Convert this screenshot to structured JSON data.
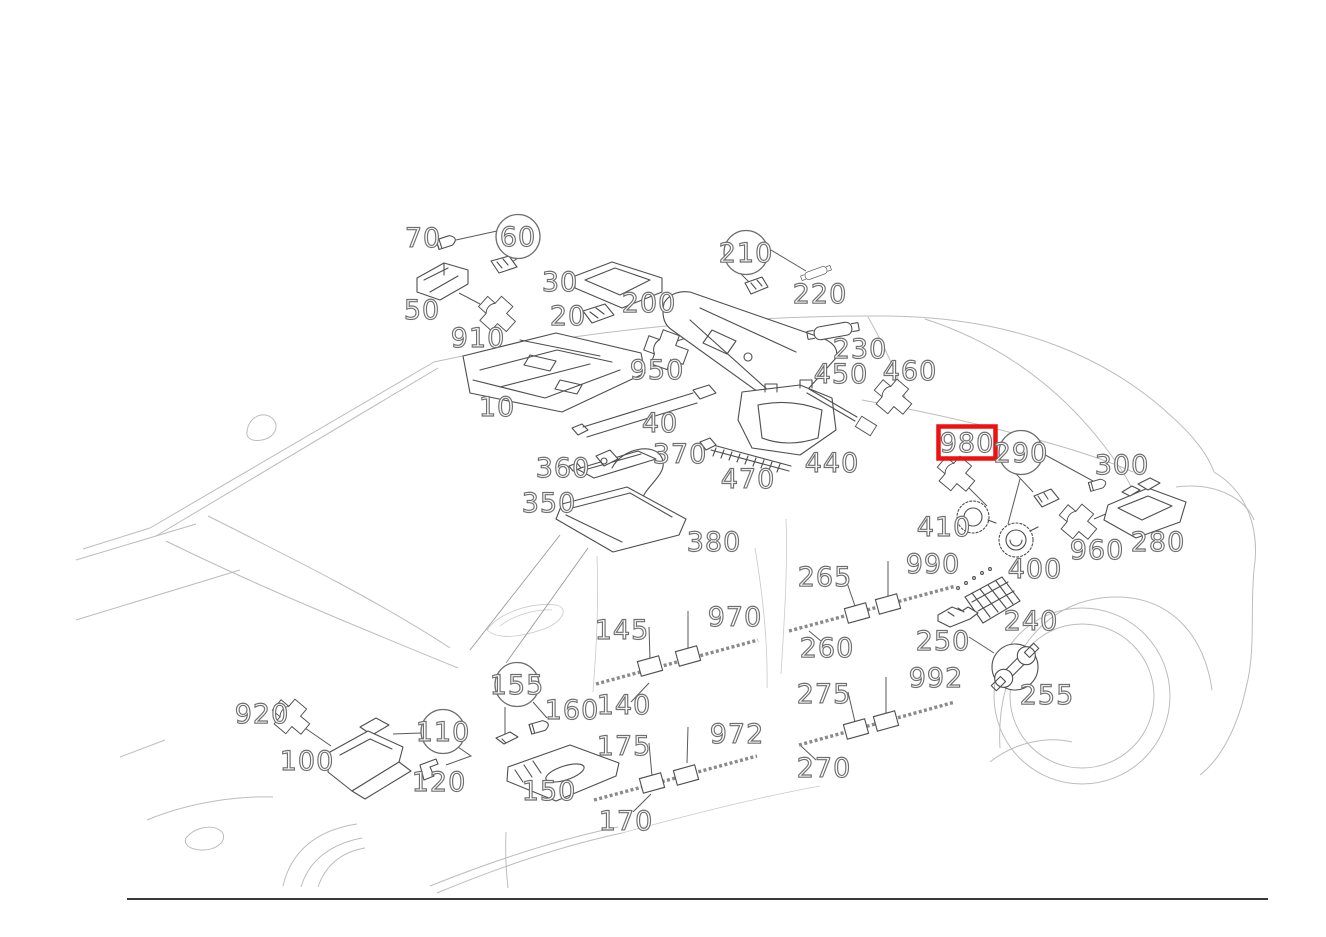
{
  "diagram": {
    "type": "exploded-parts-diagram",
    "background": "#ffffff",
    "car_outline_color": "#bcbcbc",
    "sketch_color": "#4e4e4e",
    "label_style": {
      "fill": "#ffffff",
      "outline": "#6f6f6f",
      "font_size": 27
    },
    "highlight": {
      "part": "980",
      "color": "#ee1111"
    },
    "footer_rule": {
      "y": 899,
      "x1": 127,
      "x2": 1268
    },
    "tool_icon": {
      "name": "wrench",
      "cx": 1015,
      "cy": 667,
      "r": 23,
      "for_part": "255"
    },
    "callouts": [
      {
        "label": "70",
        "x": 423,
        "y": 247,
        "kind": "plain"
      },
      {
        "label": "60",
        "x": 518,
        "y": 246,
        "kind": "circled"
      },
      {
        "label": "50",
        "x": 422,
        "y": 319,
        "kind": "plain"
      },
      {
        "label": "910",
        "x": 478,
        "y": 347,
        "kind": "plain"
      },
      {
        "label": "30",
        "x": 560,
        "y": 291,
        "kind": "plain"
      },
      {
        "label": "20",
        "x": 568,
        "y": 325,
        "kind": "plain"
      },
      {
        "label": "200",
        "x": 649,
        "y": 312,
        "kind": "plain"
      },
      {
        "label": "950",
        "x": 657,
        "y": 379,
        "kind": "plain"
      },
      {
        "label": "210",
        "x": 746,
        "y": 262,
        "kind": "circled"
      },
      {
        "label": "220",
        "x": 820,
        "y": 303,
        "kind": "plain"
      },
      {
        "label": "230",
        "x": 860,
        "y": 358,
        "kind": "plain"
      },
      {
        "label": "450",
        "x": 841,
        "y": 383,
        "kind": "plain"
      },
      {
        "label": "460",
        "x": 910,
        "y": 380,
        "kind": "plain"
      },
      {
        "label": "980",
        "x": 967,
        "y": 452,
        "kind": "highlighted"
      },
      {
        "label": "290",
        "x": 1021,
        "y": 462,
        "kind": "circled"
      },
      {
        "label": "300",
        "x": 1122,
        "y": 474,
        "kind": "plain"
      },
      {
        "label": "10",
        "x": 497,
        "y": 416,
        "kind": "plain"
      },
      {
        "label": "40",
        "x": 660,
        "y": 432,
        "kind": "plain"
      },
      {
        "label": "360",
        "x": 563,
        "y": 477,
        "kind": "plain"
      },
      {
        "label": "370",
        "x": 680,
        "y": 463,
        "kind": "plain"
      },
      {
        "label": "470",
        "x": 748,
        "y": 488,
        "kind": "plain"
      },
      {
        "label": "440",
        "x": 832,
        "y": 472,
        "kind": "plain"
      },
      {
        "label": "350",
        "x": 549,
        "y": 512,
        "kind": "plain"
      },
      {
        "label": "380",
        "x": 714,
        "y": 551,
        "kind": "plain"
      },
      {
        "label": "410",
        "x": 944,
        "y": 536,
        "kind": "plain"
      },
      {
        "label": "400",
        "x": 1035,
        "y": 578,
        "kind": "plain"
      },
      {
        "label": "960",
        "x": 1097,
        "y": 559,
        "kind": "plain"
      },
      {
        "label": "280",
        "x": 1158,
        "y": 551,
        "kind": "plain"
      },
      {
        "label": "990",
        "x": 933,
        "y": 573,
        "kind": "plain"
      },
      {
        "label": "265",
        "x": 825,
        "y": 586,
        "kind": "plain"
      },
      {
        "label": "970",
        "x": 735,
        "y": 626,
        "kind": "plain"
      },
      {
        "label": "145",
        "x": 622,
        "y": 639,
        "kind": "plain"
      },
      {
        "label": "260",
        "x": 827,
        "y": 657,
        "kind": "plain"
      },
      {
        "label": "240",
        "x": 1031,
        "y": 630,
        "kind": "plain"
      },
      {
        "label": "250",
        "x": 943,
        "y": 650,
        "kind": "plain"
      },
      {
        "label": "255",
        "x": 1047,
        "y": 704,
        "kind": "plain"
      },
      {
        "label": "155",
        "x": 517,
        "y": 694,
        "kind": "circled"
      },
      {
        "label": "160",
        "x": 572,
        "y": 719,
        "kind": "plain"
      },
      {
        "label": "140",
        "x": 624,
        "y": 714,
        "kind": "plain"
      },
      {
        "label": "110",
        "x": 443,
        "y": 741,
        "kind": "circled"
      },
      {
        "label": "920",
        "x": 262,
        "y": 723,
        "kind": "plain"
      },
      {
        "label": "100",
        "x": 307,
        "y": 770,
        "kind": "plain"
      },
      {
        "label": "120",
        "x": 439,
        "y": 791,
        "kind": "plain"
      },
      {
        "label": "150",
        "x": 549,
        "y": 800,
        "kind": "plain"
      },
      {
        "label": "175",
        "x": 624,
        "y": 755,
        "kind": "plain"
      },
      {
        "label": "972",
        "x": 737,
        "y": 743,
        "kind": "plain"
      },
      {
        "label": "170",
        "x": 626,
        "y": 830,
        "kind": "plain"
      },
      {
        "label": "275",
        "x": 824,
        "y": 703,
        "kind": "plain"
      },
      {
        "label": "992",
        "x": 936,
        "y": 687,
        "kind": "plain"
      },
      {
        "label": "270",
        "x": 824,
        "y": 777,
        "kind": "plain"
      }
    ]
  }
}
